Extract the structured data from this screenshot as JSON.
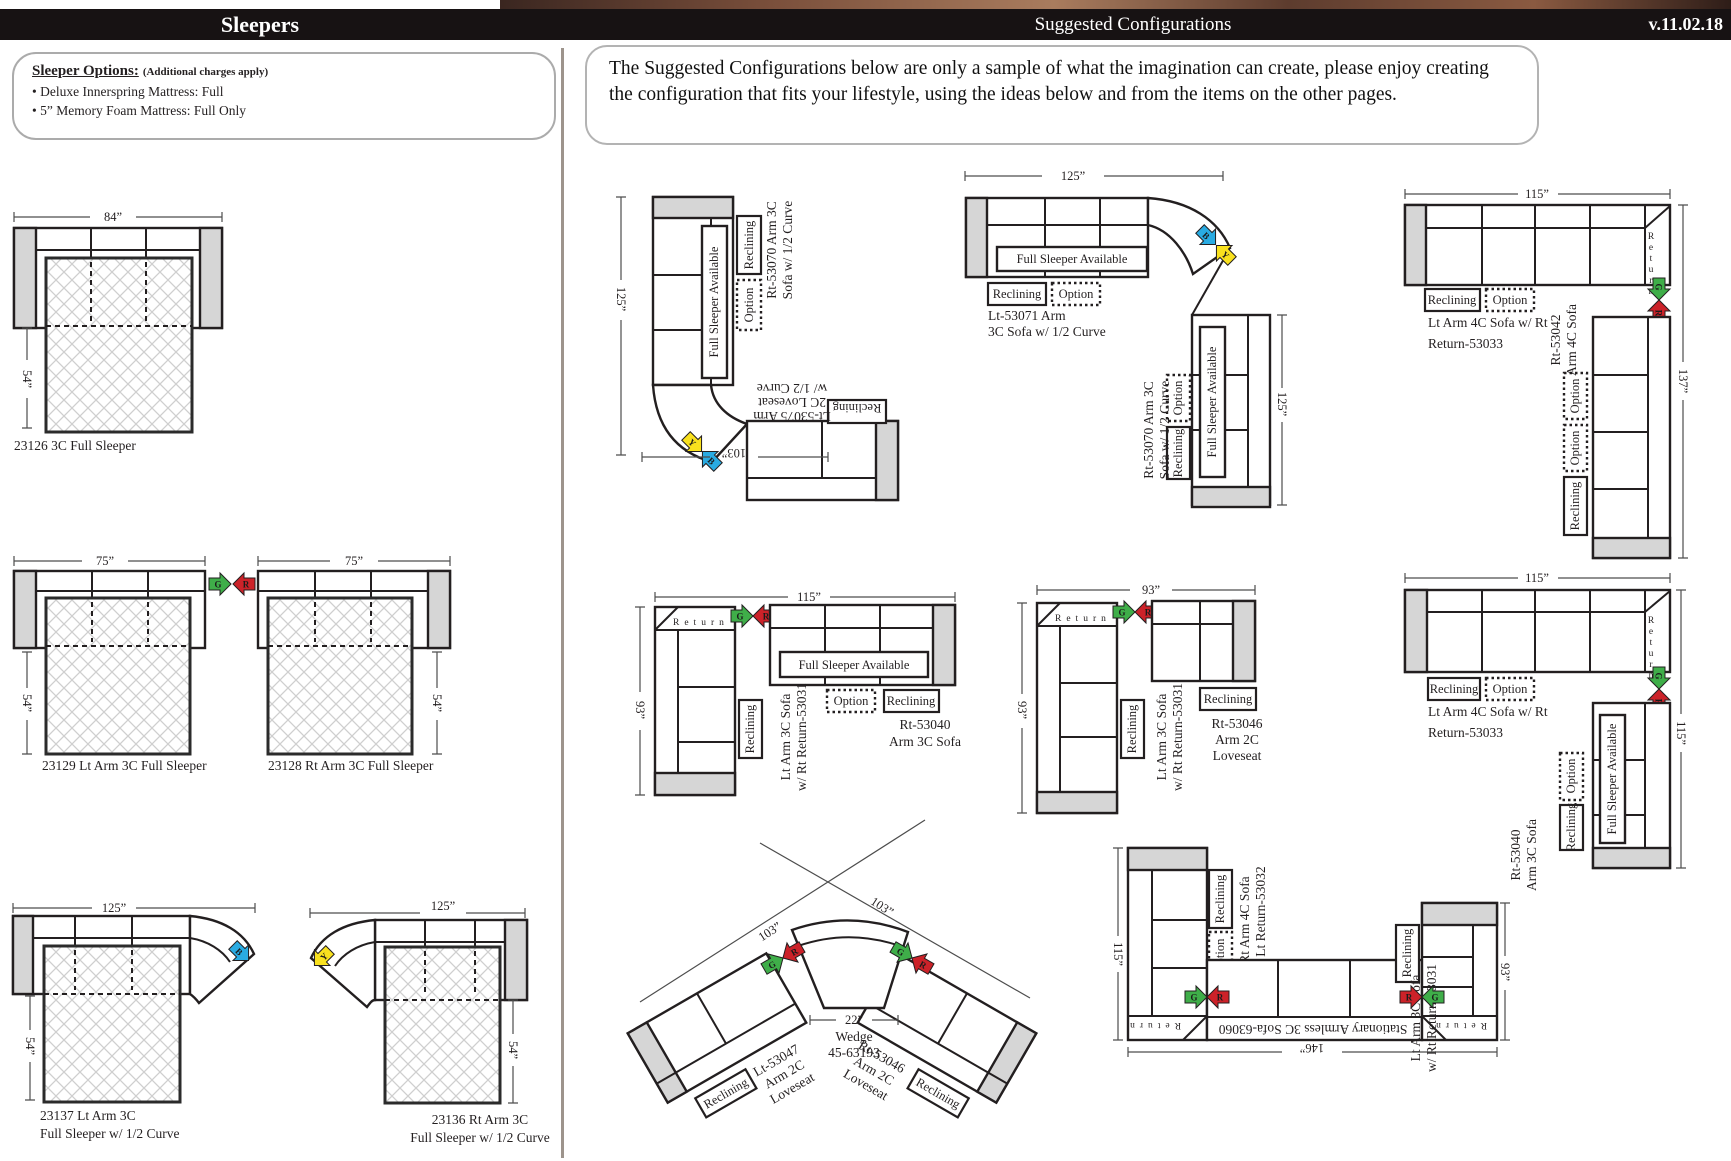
{
  "header": {
    "left_title": "Sleepers",
    "right_title": "Suggested Configurations",
    "version": "v.11.02.18"
  },
  "options": {
    "title": "Sleeper Options:",
    "note": "(Additional charges apply)",
    "items": [
      "Deluxe Innerspring Mattress: Full",
      "5” Memory Foam Mattress: Full Only"
    ]
  },
  "intro": {
    "text": "The Suggested Configurations below are only a sample of what the imagination can create, please enjoy creating the configuration that fits your lifestyle, using the ideas below and from the items on the other pages."
  },
  "badges": {
    "reclining": "Reclining",
    "option": "Option",
    "full_sleeper": "Full Sleeper Available",
    "return_word": "Return"
  },
  "arrows": {
    "g": "G",
    "r": "R",
    "b": "B",
    "y": "Y"
  },
  "left": [
    {
      "label": "23126 3C Full Sleeper",
      "width": "84”",
      "depth": "54”"
    },
    {
      "label": "23129 Lt Arm 3C Full Sleeper",
      "width": "75”",
      "depth": "54”"
    },
    {
      "label": "23128 Rt Arm 3C Full Sleeper",
      "width": "75”",
      "depth": "54”"
    },
    {
      "label1": "23137 Lt Arm 3C",
      "label2": "Full Sleeper w/ 1/2 Curve",
      "width": "125”",
      "depth": "54”"
    },
    {
      "label1": "23136 Rt Arm 3C",
      "label2": "Full Sleeper w/ 1/2 Curve",
      "width": "125”",
      "depth": "54”"
    }
  ],
  "cfg": {
    "c1": {
      "height": "125”",
      "width": "103”",
      "sofa1": "Rt-53070 Arm 3C",
      "sofa2": "Sofa w/ 1/2 Curve",
      "love1": "Lt-53075 Arm",
      "love2": "2C Loveseat",
      "love3": "w/ 1/2 Curve"
    },
    "c2": {
      "top": "125”",
      "right": "125”",
      "sofa1": "Lt-53071 Arm",
      "sofa2": "3C Sofa w/ 1/2 Curve",
      "vert1": "Rt-53070 Arm 3C",
      "vert2": "Sofa w/ 1/2 Curve"
    },
    "c3": {
      "top": "115”",
      "right": "137”",
      "sofa1": "Lt Arm 4C Sofa w/ Rt",
      "sofa2": "Return-53033",
      "vert1": "Rt-53042",
      "vert2": "Arm 4C Sofa"
    },
    "c4": {
      "top": "115”",
      "left": "93”",
      "sofa1": "Rt-53040",
      "sofa2": "Arm 3C Sofa",
      "vert1": "Lt Arm 3C Sofa",
      "vert2": "w/ Rt Return-53031"
    },
    "c5": {
      "top": "93”",
      "left": "93”",
      "love1": "Rt-53046",
      "love2": "Arm 2C",
      "love3": "Loveseat",
      "vert1": "Lt Arm 3C Sofa",
      "vert2": "w/ Rt Return-53031"
    },
    "c6": {
      "top": "115”",
      "right": "115”",
      "sofa1": "Lt Arm 4C Sofa w/ Rt",
      "sofa2": "Return-53033",
      "vert1": "Rt-53040",
      "vert2": "Arm 3C Sofa"
    },
    "c7": {
      "dimL": "103”",
      "dimR": "103”",
      "dimW": "22”",
      "wedge1": "Wedge",
      "wedge2": "45-63193",
      "l1": "Lt-53047",
      "l2": "Arm 2C",
      "l3": "Loveseat",
      "r1": "Rt-53046",
      "r2": "Arm 2C",
      "r3": "Loveseat"
    },
    "c8": {
      "left": "115”",
      "right": "93”",
      "bottom": "146”",
      "lv1": "Rt Arm 4C Sofa",
      "lv2": "w/ Lt Return-53032",
      "mid": "Stationary Armless 3C Sofa-63060",
      "rv1": "Lt Arm 3C Sofa",
      "rv2": "w/ Rt Return-53031"
    }
  }
}
